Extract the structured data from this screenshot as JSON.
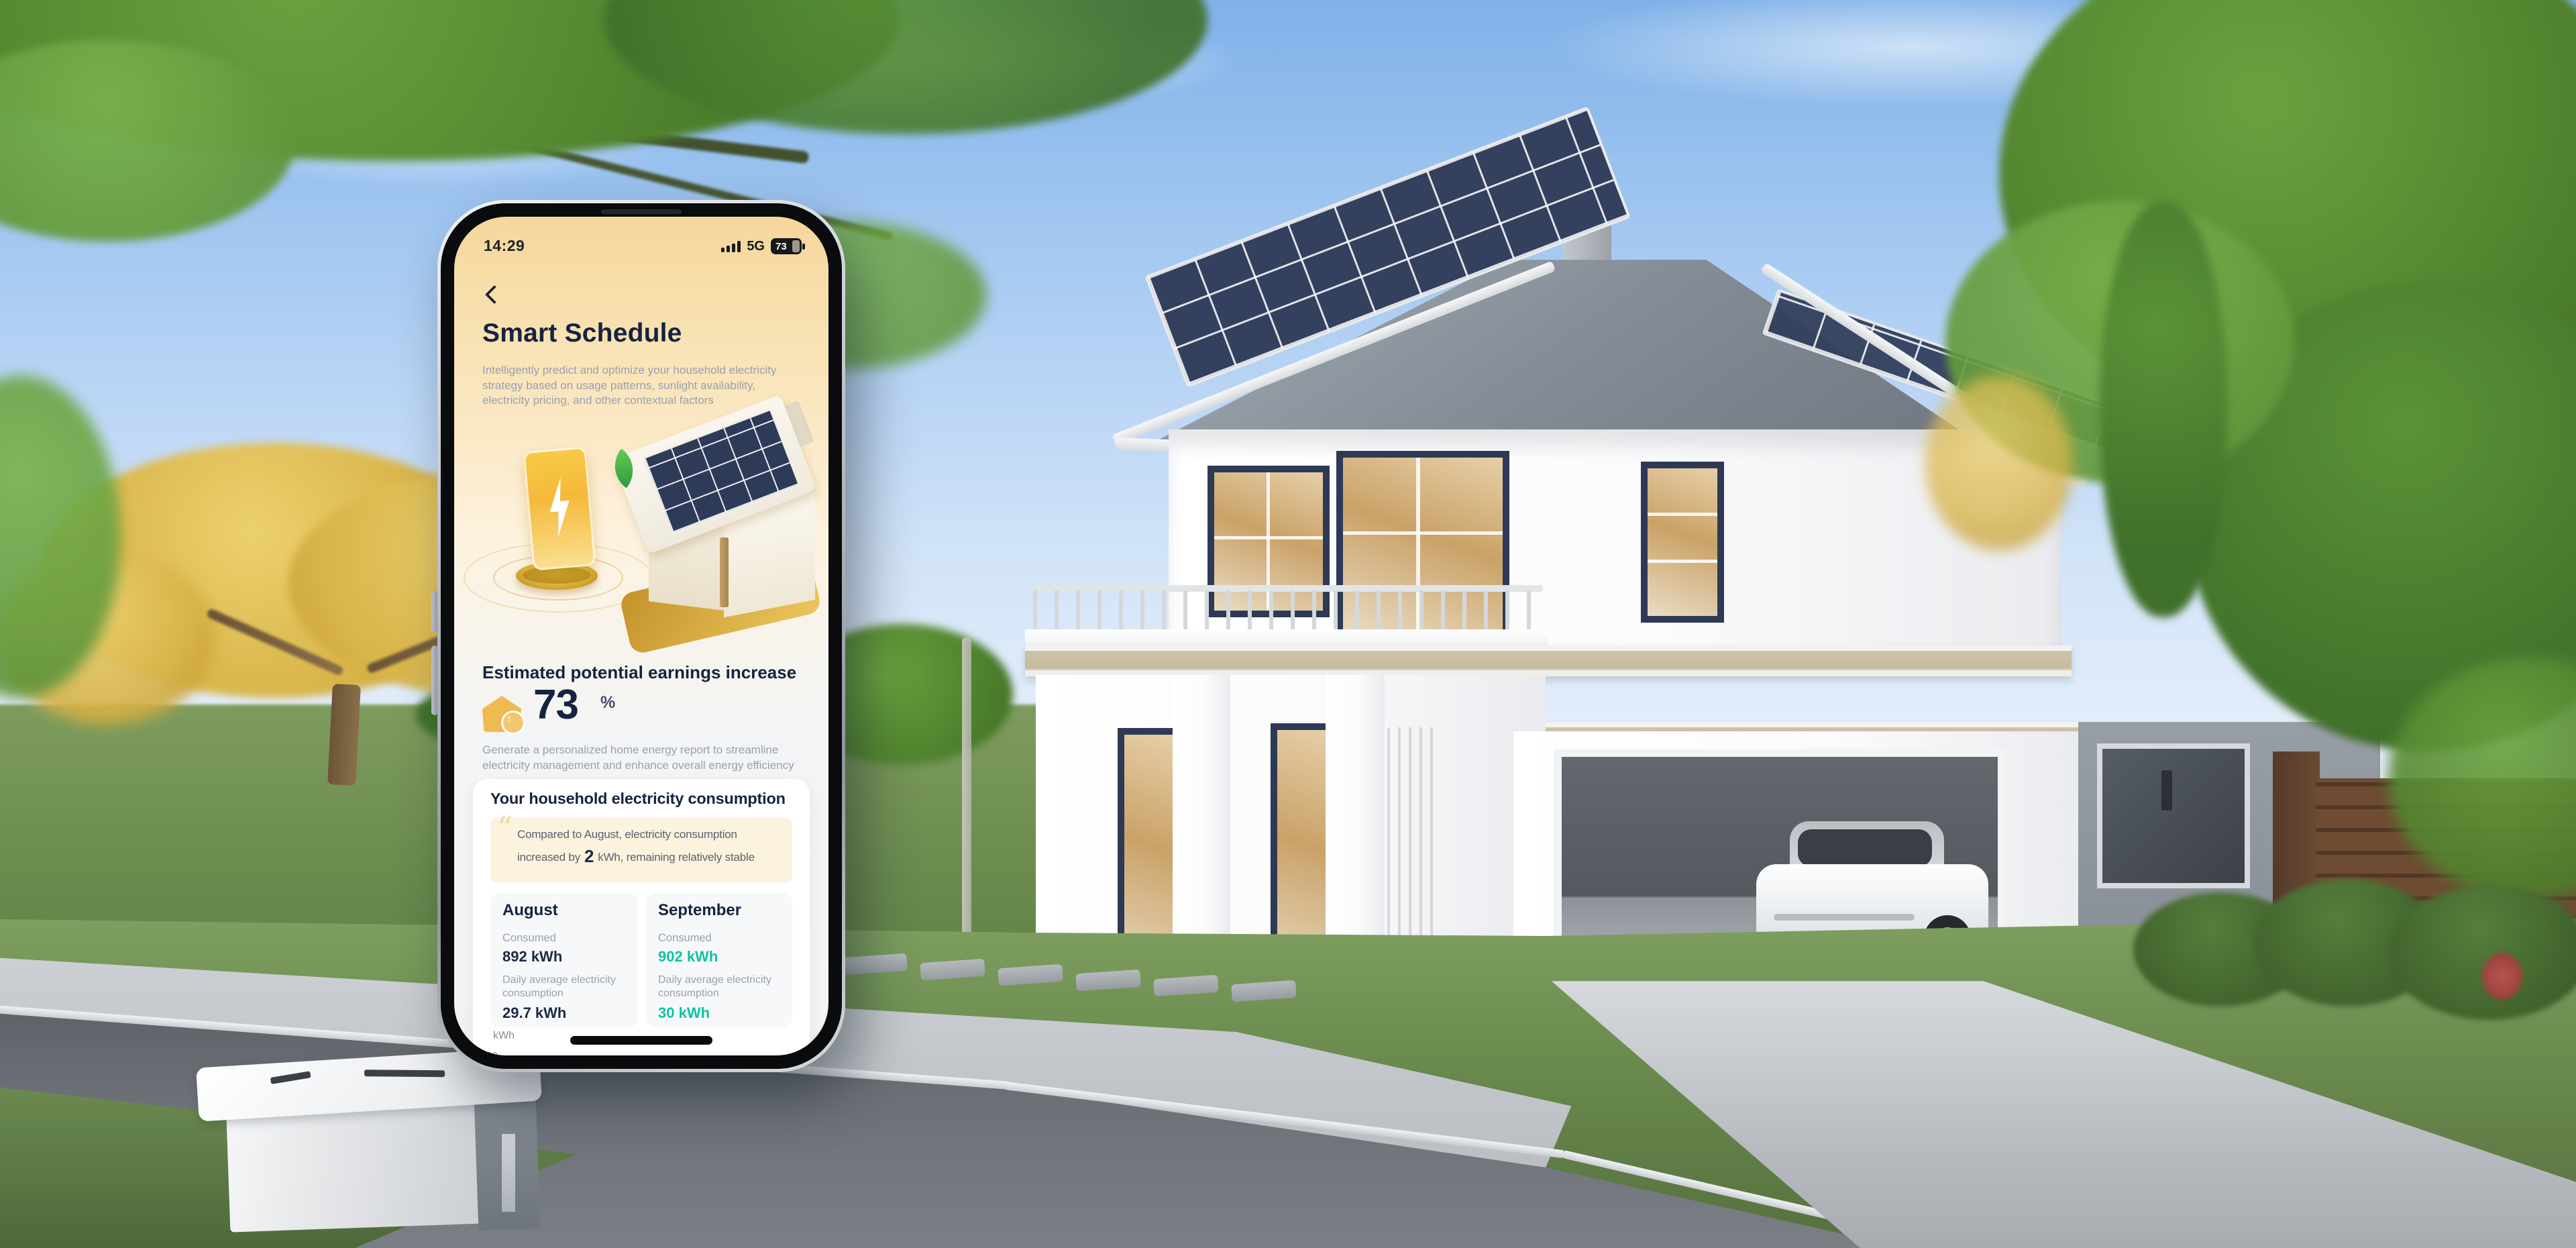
{
  "app": {
    "status_bar": {
      "time": "14:29",
      "network": "5G",
      "battery_percent": "73"
    },
    "header": {
      "title": "Smart Schedule",
      "description": "Intelligently predict and optimize your household electricity strategy based on usage patterns, sunlight availability, electricity pricing, and other contextual factors"
    },
    "earnings": {
      "label": "Estimated potential earnings increase",
      "value": "73",
      "unit": "%"
    },
    "report_note": "Generate a personalized home energy report to streamline electricity management and enhance overall energy efficiency",
    "consumption": {
      "title": "Your household electricity consumption",
      "note_before": "Compared to August, electricity consumption increased by",
      "note_value": "2",
      "note_after": "kWh,  remaining relatively stable",
      "months": [
        {
          "name": "August",
          "consumed_label": "Consumed",
          "consumed_value": "892 kWh",
          "daily_label": "Daily average electricity consumption",
          "daily_value": "29.7 kWh"
        },
        {
          "name": "September",
          "consumed_label": "Consumed",
          "consumed_value": "902 kWh",
          "daily_label": "Daily average electricity consumption",
          "daily_value": "30 kWh"
        }
      ],
      "chart": {
        "unit": "kWh",
        "tick": "60"
      }
    }
  },
  "icons": {
    "back": "chevron-left",
    "signal": "signal-bars",
    "battery": "battery-73",
    "quote_glyph": "“",
    "up_arrow_glyph": "↑",
    "earnings_house": "house-up-arrow",
    "bolt": "lightning-bolt",
    "leaf": "leaf"
  },
  "colors": {
    "accent_teal": "#0cc3a4",
    "navy_text": "#15233f",
    "muted_text": "#9aa0ab",
    "warm_top": "#f6d79c",
    "note_cream": "#fbf3dd",
    "amber_icon": "#f0ba52"
  }
}
